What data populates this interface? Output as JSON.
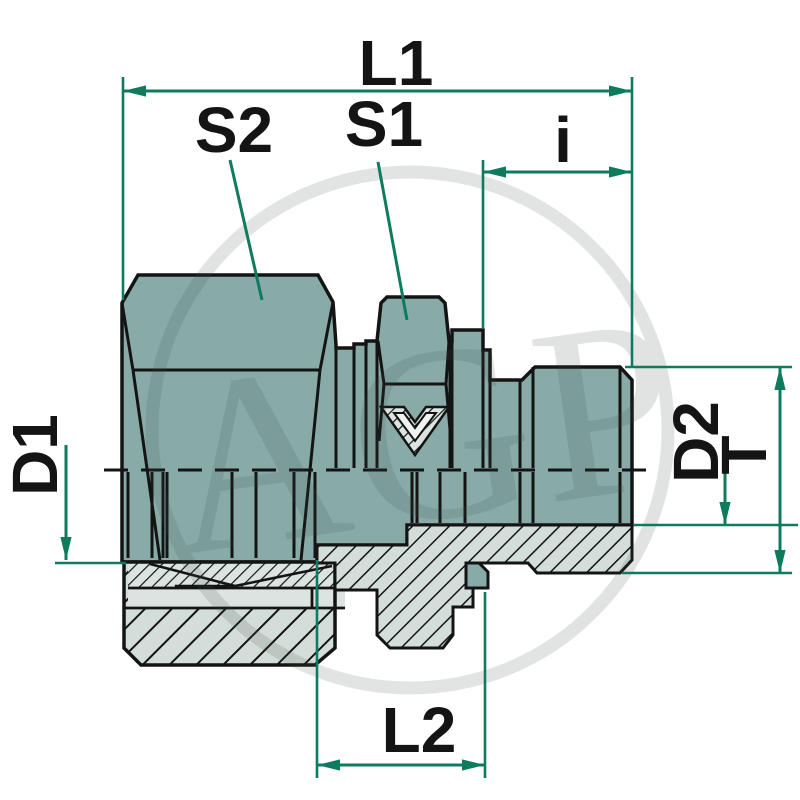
{
  "diagram": {
    "type": "technical-dimension-drawing",
    "subject": "straight male stud compression fitting, half section",
    "watermark": "AGP",
    "labels": {
      "l1": "L1",
      "s2": "S2",
      "s1": "S1",
      "i": "i",
      "d1": "D1",
      "d2": "D2",
      "t": "T",
      "l2": "L2"
    },
    "colors": {
      "dimension": "#0e7b5f",
      "ink": "#141414",
      "body": "#88aba8",
      "section": "#d3ddd9",
      "section_light": "#dce4e1",
      "detail_light": "#e3eae7",
      "symbol_light": "#eef2f0",
      "watermark": "#3c4a46",
      "background": "#ffffff"
    }
  }
}
